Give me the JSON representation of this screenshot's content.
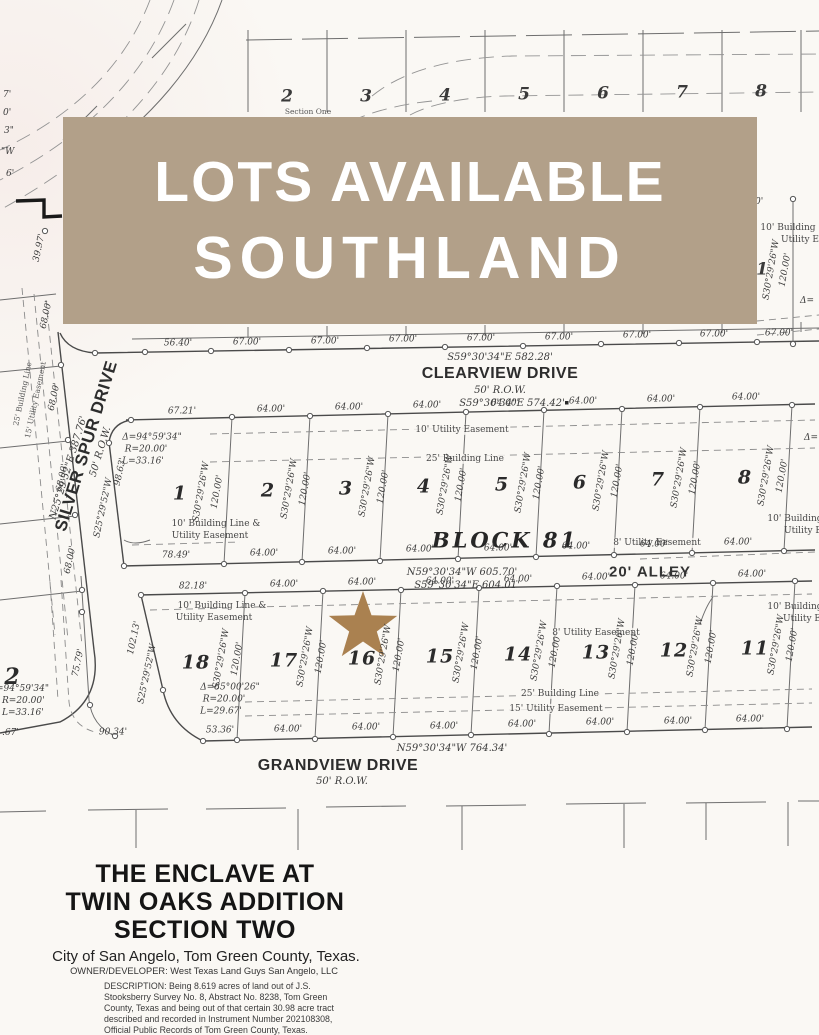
{
  "banner": {
    "line1": "LOTS AVAILABLE",
    "line2": "SOUTHLAND",
    "bg_color": "#b2a089",
    "text_color": "#ffffff",
    "style": "background:#b2a089"
  },
  "colors": {
    "star": "#aa8150",
    "line": "#4a4a4a",
    "paper": "#faf8f4"
  },
  "streets": {
    "clearview": {
      "name": "CLEARVIEW DRIVE",
      "row": "50' R.O.W."
    },
    "grandview": {
      "name": "GRANDVIEW DRIVE",
      "row": "50' R.O.W."
    },
    "silver_spur": {
      "name": "SILVER SPUR DRIVE",
      "row": "50' R.O.W.",
      "bearing": "N25°29'52\"E   387.76'"
    },
    "alley": "20' ALLEY"
  },
  "block": {
    "name": "BLOCK 81"
  },
  "brg": {
    "clearview_n": "S59°30'34\"E    582.28'",
    "block_n": "S59°30'34\"E    574.42'",
    "alley_n": "N59°30'34\"W    605.70'",
    "alley_s": "S59°30'34\"E    604.01'",
    "grandview": "N59°30'34\"W    764.34'",
    "lot_bearing": "S30°29'26\"W",
    "lot_depth": "120.00'",
    "west_bearing": "S25°29'52\"W",
    "west_dim": "98.63'",
    "west_dim2": "102.13'"
  },
  "curves": {
    "c1": {
      "delta": "Δ=94°59'34\"",
      "r": "R=20.00'",
      "l": "L=33.16'"
    },
    "c2": {
      "delta": "Δ=85°00'26\"",
      "r": "R=20.00'",
      "l": "L=29.67'"
    },
    "c3": {
      "delta": "=94°59'34\"",
      "r": "R=20.00'",
      "l": "L=33.16'"
    }
  },
  "ease": {
    "ue10": "10' Utility Easement",
    "bl25": "25' Building Line",
    "ue8": "8' Utility Easement",
    "ue15": "15' Utility Easement",
    "blue1": "10' Building Line &",
    "blue2": "Utility Easement",
    "right1": "10' Building",
    "right2": "Utility E"
  },
  "dims": {
    "clearview_n": [
      "56.40'",
      "67.00'",
      "67.00'",
      "67.00'",
      "67.00'",
      "67.00'",
      "67.00'",
      "67.00'",
      "67.00'"
    ],
    "upper_top": [
      "67.21'",
      "64.00'",
      "64.00'",
      "64.00'",
      "64.00'",
      "64.00'",
      "64.00'",
      "64.00'"
    ],
    "upper_bottom": [
      "78.49'",
      "64.00'",
      "64.00'",
      "64.00'",
      "64.00'",
      "64.00'",
      "64.00'",
      "64.00'"
    ],
    "lower_top": [
      "82.18'",
      "64.00'",
      "64.00'",
      "64.00'",
      "64.00'",
      "64.00'",
      "64.00'",
      "64.00'"
    ],
    "lower_bottom": [
      "90.34'",
      "53.36'",
      "64.00'",
      "64.00'",
      "64.00'",
      "64.00'",
      "64.00'",
      "64.00'",
      "64.00'"
    ],
    "west_side": [
      "39.97'",
      "68.00'",
      "68.00'",
      "68.00'",
      "68.00'"
    ],
    "d7579": "75.79'"
  },
  "lots": {
    "north_row": [
      "2",
      "3",
      "4",
      "5",
      "6",
      "7",
      "8"
    ],
    "upper_row": [
      "1",
      "2",
      "3",
      "4",
      "5",
      "6",
      "7",
      "8"
    ],
    "lower_row": [
      "18",
      "17",
      "16",
      "15",
      "14",
      "13",
      "12",
      "11"
    ],
    "left_partial": "2"
  },
  "fragments": {
    "f1": "7'",
    "f2": "0'",
    "f3": "3\"",
    "f4": "\"W",
    "f5": "6'",
    "f6": "0'",
    "f7": "1",
    "f8": "Δ=",
    "f9": "Δ=",
    "f10": ".67'",
    "section_one": "Section One"
  },
  "title": {
    "l1": "THE ENCLAVE AT",
    "l2": "TWIN OAKS ADDITION",
    "l3": "SECTION TWO",
    "city": "City of San Angelo, Tom Green County, Texas.",
    "owner": "OWNER/DEVELOPER:  West Texas Land Guys San Angelo, LLC",
    "desc1": "DESCRIPTION:   Being 8.619 acres of land out of J.S.",
    "desc2": "Stooksberry Survey No. 8, Abstract No. 8238, Tom Green",
    "desc3": "County, Texas and being out of that certain 30.98 acre tract",
    "desc4": "described and recorded in Instrument Number 202108308,",
    "desc5": "Official Public Records of Tom Green County, Texas."
  }
}
